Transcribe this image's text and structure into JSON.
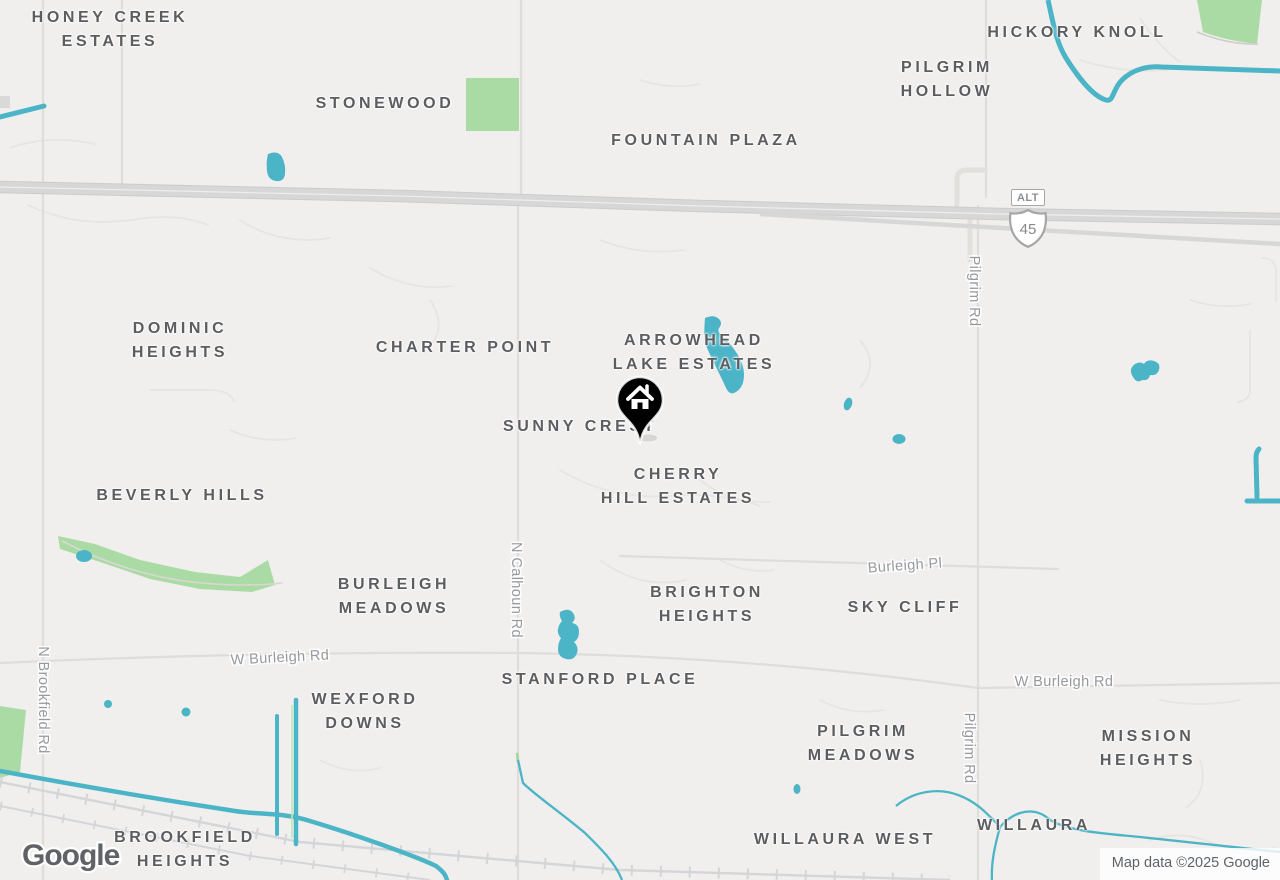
{
  "map": {
    "colors": {
      "background": "#f0efed",
      "water": "#4bb5c7",
      "park": "#abdba4",
      "highway": "#d7d7d7",
      "minor_road": "#e7e5e2",
      "railroad": "#d3d5d9",
      "place_label": "#5c5d61",
      "road_label": "#96999e",
      "marker": "#000000"
    },
    "place_labels": [
      {
        "name": "label-honey-creek-estates",
        "lines": [
          "HONEY CREEK",
          "ESTATES"
        ],
        "x": 110,
        "y": 30
      },
      {
        "name": "label-stonewood",
        "lines": [
          "STONEWOOD"
        ],
        "x": 385,
        "y": 104
      },
      {
        "name": "label-fountain-plaza",
        "lines": [
          "FOUNTAIN PLAZA"
        ],
        "x": 706,
        "y": 141
      },
      {
        "name": "label-hickory-knoll",
        "lines": [
          "HICKORY KNOLL"
        ],
        "x": 1077,
        "y": 33
      },
      {
        "name": "label-pilgrim-hollow",
        "lines": [
          "PILGRIM",
          "HOLLOW"
        ],
        "x": 947,
        "y": 80
      },
      {
        "name": "label-dominic-heights",
        "lines": [
          "DOMINIC",
          "HEIGHTS"
        ],
        "x": 180,
        "y": 341
      },
      {
        "name": "label-charter-point",
        "lines": [
          "CHARTER POINT"
        ],
        "x": 465,
        "y": 348
      },
      {
        "name": "label-arrowhead-lake-estates",
        "lines": [
          "ARROWHEAD",
          "LAKE ESTATES"
        ],
        "x": 694,
        "y": 353
      },
      {
        "name": "label-sunny-crest",
        "lines": [
          "SUNNY CREST"
        ],
        "x": 580,
        "y": 427
      },
      {
        "name": "label-cherry-hill-estates",
        "lines": [
          "CHERRY",
          "HILL ESTATES"
        ],
        "x": 678,
        "y": 487
      },
      {
        "name": "label-beverly-hills",
        "lines": [
          "BEVERLY HILLS"
        ],
        "x": 182,
        "y": 496
      },
      {
        "name": "label-burleigh-meadows",
        "lines": [
          "BURLEIGH",
          "MEADOWS"
        ],
        "x": 394,
        "y": 597
      },
      {
        "name": "label-brighton-heights",
        "lines": [
          "BRIGHTON",
          "HEIGHTS"
        ],
        "x": 707,
        "y": 605
      },
      {
        "name": "label-sky-cliff",
        "lines": [
          "SKY CLIFF"
        ],
        "x": 905,
        "y": 608
      },
      {
        "name": "label-stanford-place",
        "lines": [
          "STANFORD PLACE"
        ],
        "x": 600,
        "y": 680
      },
      {
        "name": "label-wexford-downs",
        "lines": [
          "WEXFORD",
          "DOWNS"
        ],
        "x": 365,
        "y": 712
      },
      {
        "name": "label-pilgrim-meadows",
        "lines": [
          "PILGRIM",
          "MEADOWS"
        ],
        "x": 863,
        "y": 744
      },
      {
        "name": "label-mission-heights",
        "lines": [
          "MISSION",
          "HEIGHTS"
        ],
        "x": 1148,
        "y": 749
      },
      {
        "name": "label-willaura-west",
        "lines": [
          "WILLAURA WEST"
        ],
        "x": 845,
        "y": 840
      },
      {
        "name": "label-willaura",
        "lines": [
          "WILLAURA"
        ],
        "x": 1034,
        "y": 826
      },
      {
        "name": "label-brookfield-heights",
        "lines": [
          "BROOKFIELD",
          "HEIGHTS"
        ],
        "x": 185,
        "y": 850
      }
    ],
    "road_labels": [
      {
        "name": "road-label-w-burleigh-rd-west",
        "text": "W Burleigh Rd",
        "x": 280,
        "y": 658,
        "rotation": -3
      },
      {
        "name": "road-label-w-burleigh-rd-east",
        "text": "W Burleigh Rd",
        "x": 1064,
        "y": 682,
        "rotation": 0
      },
      {
        "name": "road-label-burleigh-pl",
        "text": "Burleigh Pl",
        "x": 905,
        "y": 566,
        "rotation": -4
      },
      {
        "name": "road-label-n-calhoun-rd",
        "text": "N Calhoun Rd",
        "x": 516,
        "y": 590,
        "rotation": 90
      },
      {
        "name": "road-label-pilgrim-rd-north",
        "text": "Pilgrim Rd",
        "x": 974,
        "y": 291,
        "rotation": 90
      },
      {
        "name": "road-label-pilgrim-rd-south",
        "text": "Pilgrim Rd",
        "x": 969,
        "y": 748,
        "rotation": 90
      },
      {
        "name": "road-label-n-brookfield-rd",
        "text": "N Brookfield Rd",
        "x": 43,
        "y": 700,
        "rotation": 90
      }
    ],
    "highway_shield": {
      "banner": "ALT",
      "route": "45"
    },
    "marker": {
      "type": "home",
      "x": 640,
      "y": 400
    },
    "attribution": {
      "logo_text": "Google",
      "copyright_text": "Map data ©2025 Google"
    }
  }
}
